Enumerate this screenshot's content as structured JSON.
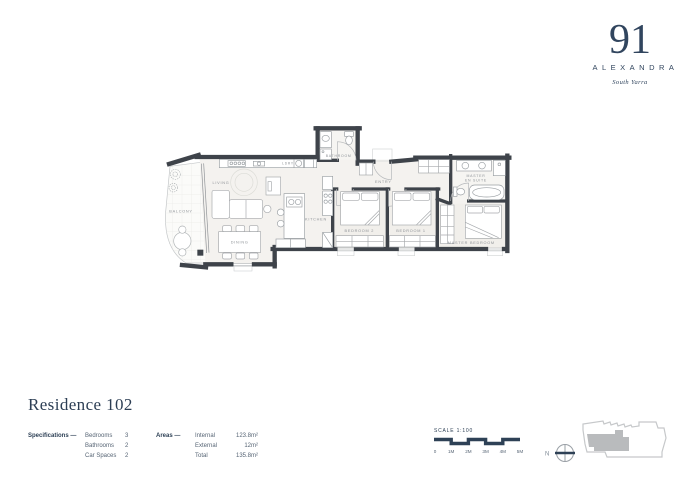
{
  "logo": {
    "number": "91",
    "name": "ALEXANDRA",
    "suburb": "South Yarra"
  },
  "title": "Residence 102",
  "specifications": {
    "heading": "Specifications —",
    "items": [
      {
        "label": "Bedrooms",
        "value": "3"
      },
      {
        "label": "Bathrooms",
        "value": "2"
      },
      {
        "label": "Car Spaces",
        "value": "2"
      }
    ]
  },
  "areas": {
    "heading": "Areas —",
    "items": [
      {
        "label": "Internal",
        "value": "123.8m²"
      },
      {
        "label": "External",
        "value": "12m²"
      },
      {
        "label": "Total",
        "value": "135.8m²"
      }
    ]
  },
  "scale": {
    "label": "SCALE 1:100",
    "ticks": [
      "0",
      "1M",
      "2M",
      "3M",
      "4M",
      "5M"
    ]
  },
  "north": {
    "label": "N"
  },
  "plan": {
    "rooms": [
      {
        "id": "balcony",
        "label": "BALCONY"
      },
      {
        "id": "living",
        "label": "LIVING"
      },
      {
        "id": "dining",
        "label": "DINING"
      },
      {
        "id": "kitchen",
        "label": "KITCHEN"
      },
      {
        "id": "laundry",
        "label": "LDRY"
      },
      {
        "id": "bathroom",
        "label": "BATHROOM"
      },
      {
        "id": "entry",
        "label": "ENTRY"
      },
      {
        "id": "bedroom2",
        "label": "BEDROOM 2"
      },
      {
        "id": "bedroom1",
        "label": "BEDROOM 1"
      },
      {
        "id": "ensuite-line1",
        "label": "MASTER"
      },
      {
        "id": "ensuite-line2",
        "label": "EN SUITE"
      },
      {
        "id": "master-bedroom",
        "label": "MASTER BEDROOM"
      }
    ]
  },
  "colors": {
    "navy": "#2e4156",
    "wall": "#3e434a",
    "floor": "#f4f2ef",
    "line": "#a6a9ac",
    "keyfill": "#b9bbbd"
  }
}
